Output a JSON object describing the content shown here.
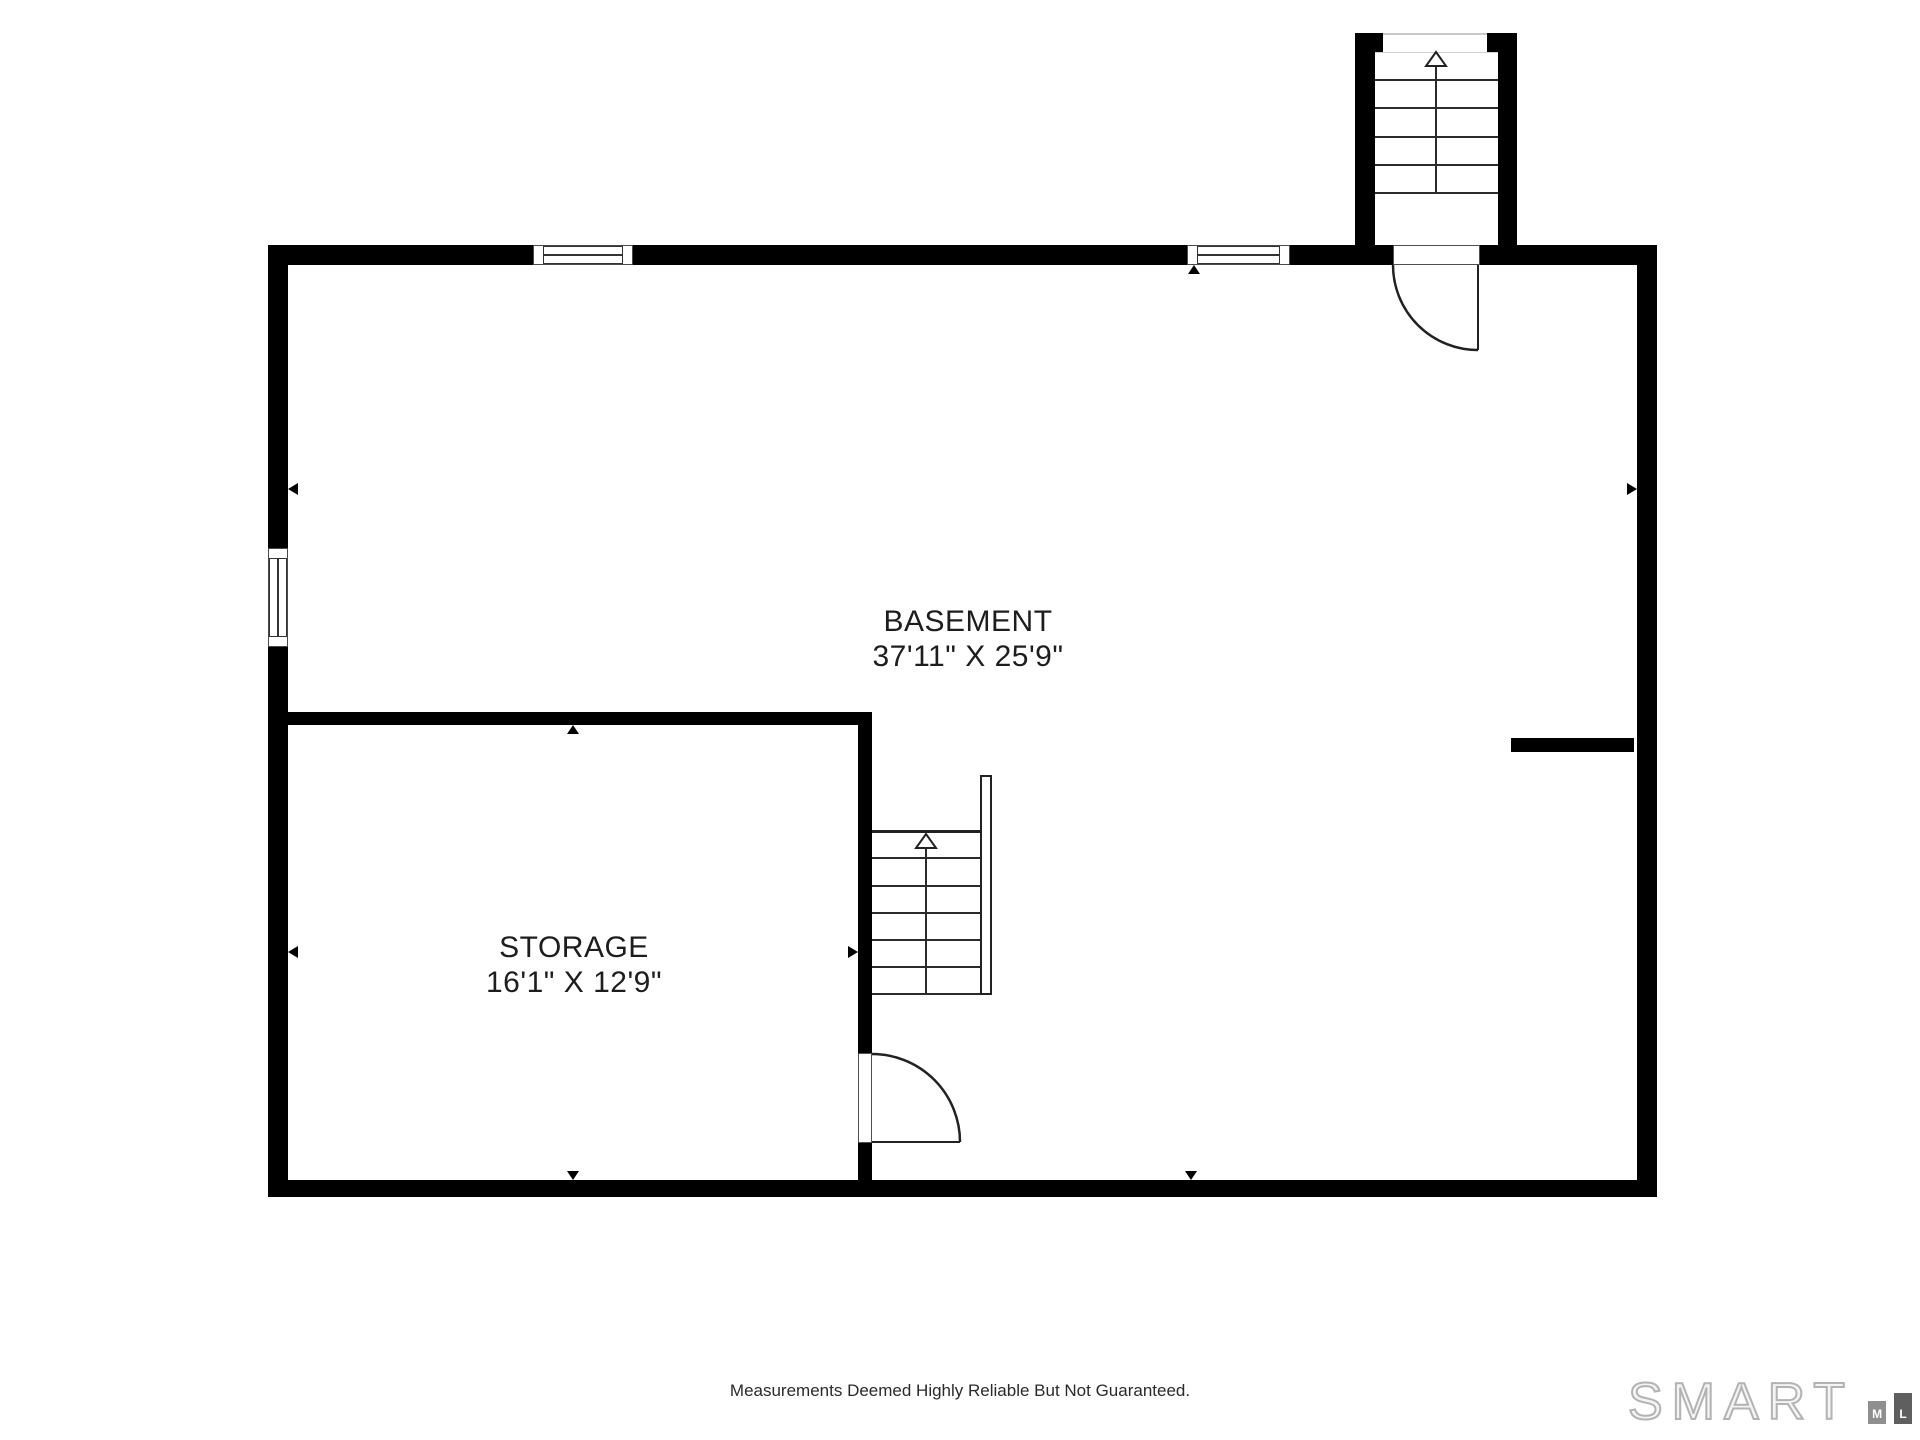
{
  "plan": {
    "rooms": [
      {
        "name": "BASEMENT",
        "dimensions": "37'11\" X 25'9\""
      },
      {
        "name": "STORAGE",
        "dimensions": "16'1\" X 12'9\""
      }
    ],
    "wall_color": "#000000",
    "stair_line_color": "#2b2b2b",
    "top_stairs_treads": 5,
    "middle_stairs_treads": 6
  },
  "footer": {
    "disclaimer": "Measurements Deemed Highly Reliable But Not Guaranteed."
  },
  "logo": {
    "brand": "SMART",
    "bar_letters": [
      "M",
      "L",
      "S"
    ],
    "bar_colors": [
      "#8f8f8f",
      "#5f5f5f",
      "#3e3e3e"
    ],
    "outline_color": "#b3b3b3"
  }
}
